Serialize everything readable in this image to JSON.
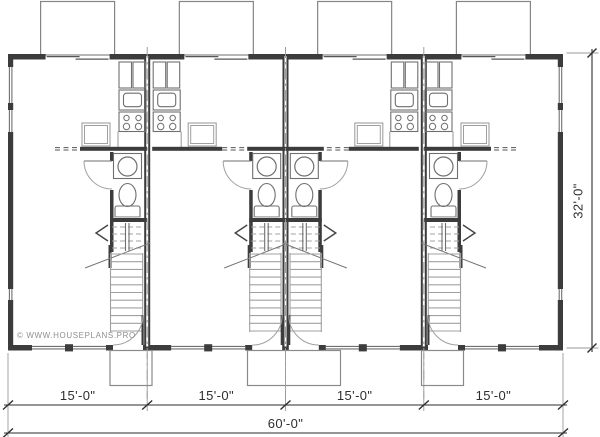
{
  "watermark": {
    "text": "© WWW.HOUSEPLANS.PRO"
  },
  "dimensions": {
    "unit_widths": [
      {
        "label": "15'-0\""
      },
      {
        "label": "15'-0\""
      },
      {
        "label": "15'-0\""
      },
      {
        "label": "15'-0\""
      }
    ],
    "total_width": {
      "label": "60'-0\""
    },
    "depth": {
      "label": "32'-0\""
    }
  },
  "plan": {
    "type": "fourplex-townhouse-floor-plan",
    "units": [
      {
        "name": "unit-1",
        "kitchen_side": "right",
        "service_side": "right"
      },
      {
        "name": "unit-2",
        "kitchen_side": "left",
        "service_side": "right"
      },
      {
        "name": "unit-3",
        "kitchen_side": "right",
        "service_side": "left"
      },
      {
        "name": "unit-4",
        "kitchen_side": "left",
        "service_side": "left"
      }
    ],
    "features_per_unit": [
      "deck",
      "sliding-patio-door",
      "kitchen",
      "bathroom",
      "stairs",
      "front-door",
      "stoop"
    ],
    "colors": {
      "wall": "#3c3c3c",
      "fixture": "#6f6f6f",
      "light": "#a0a0a0",
      "dimension": "#2e2e2e",
      "centerline": "#9c9c9c"
    }
  }
}
